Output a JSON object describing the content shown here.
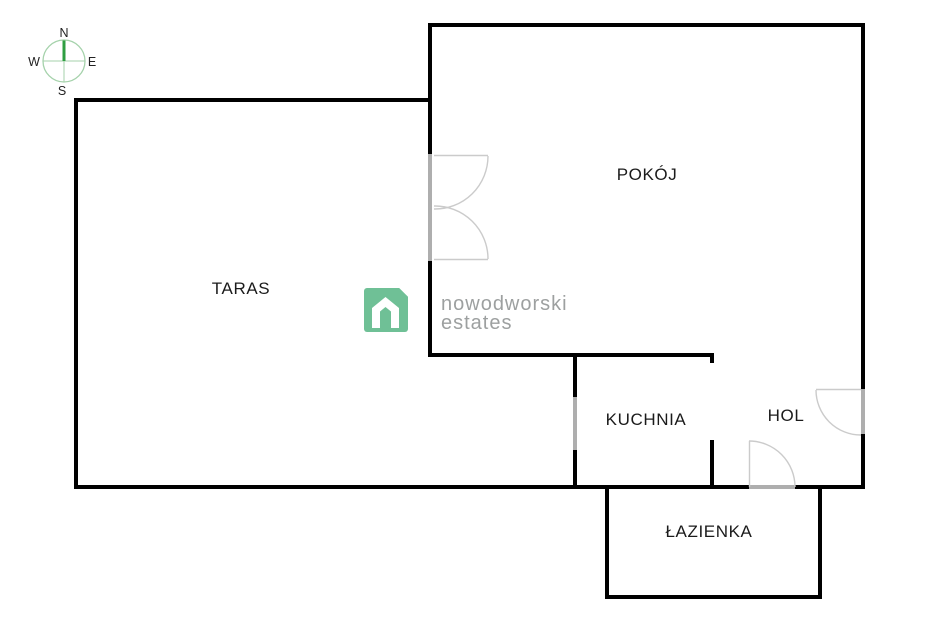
{
  "compass": {
    "north": "N",
    "south": "S",
    "west": "W",
    "east": "E"
  },
  "rooms": {
    "taras": "TARAS",
    "pokoj": "POKÓJ",
    "kuchnia": "KUCHNIA",
    "hol": "HOL",
    "lazienka": "ŁAZIENKA"
  },
  "watermark": {
    "brand_line1": "nowodworski",
    "brand_line2": "estates"
  },
  "colors": {
    "wall": "#000000",
    "door_line": "#cbcbcb",
    "opening": "#aeaeae",
    "brand_green": "#6fc096",
    "brand_text_gray": "#9da0a0",
    "compass_green_dark": "#2f9e41",
    "compass_green_light": "#a5d2ab",
    "label_text": "#1b1b1b",
    "background": "#ffffff"
  }
}
